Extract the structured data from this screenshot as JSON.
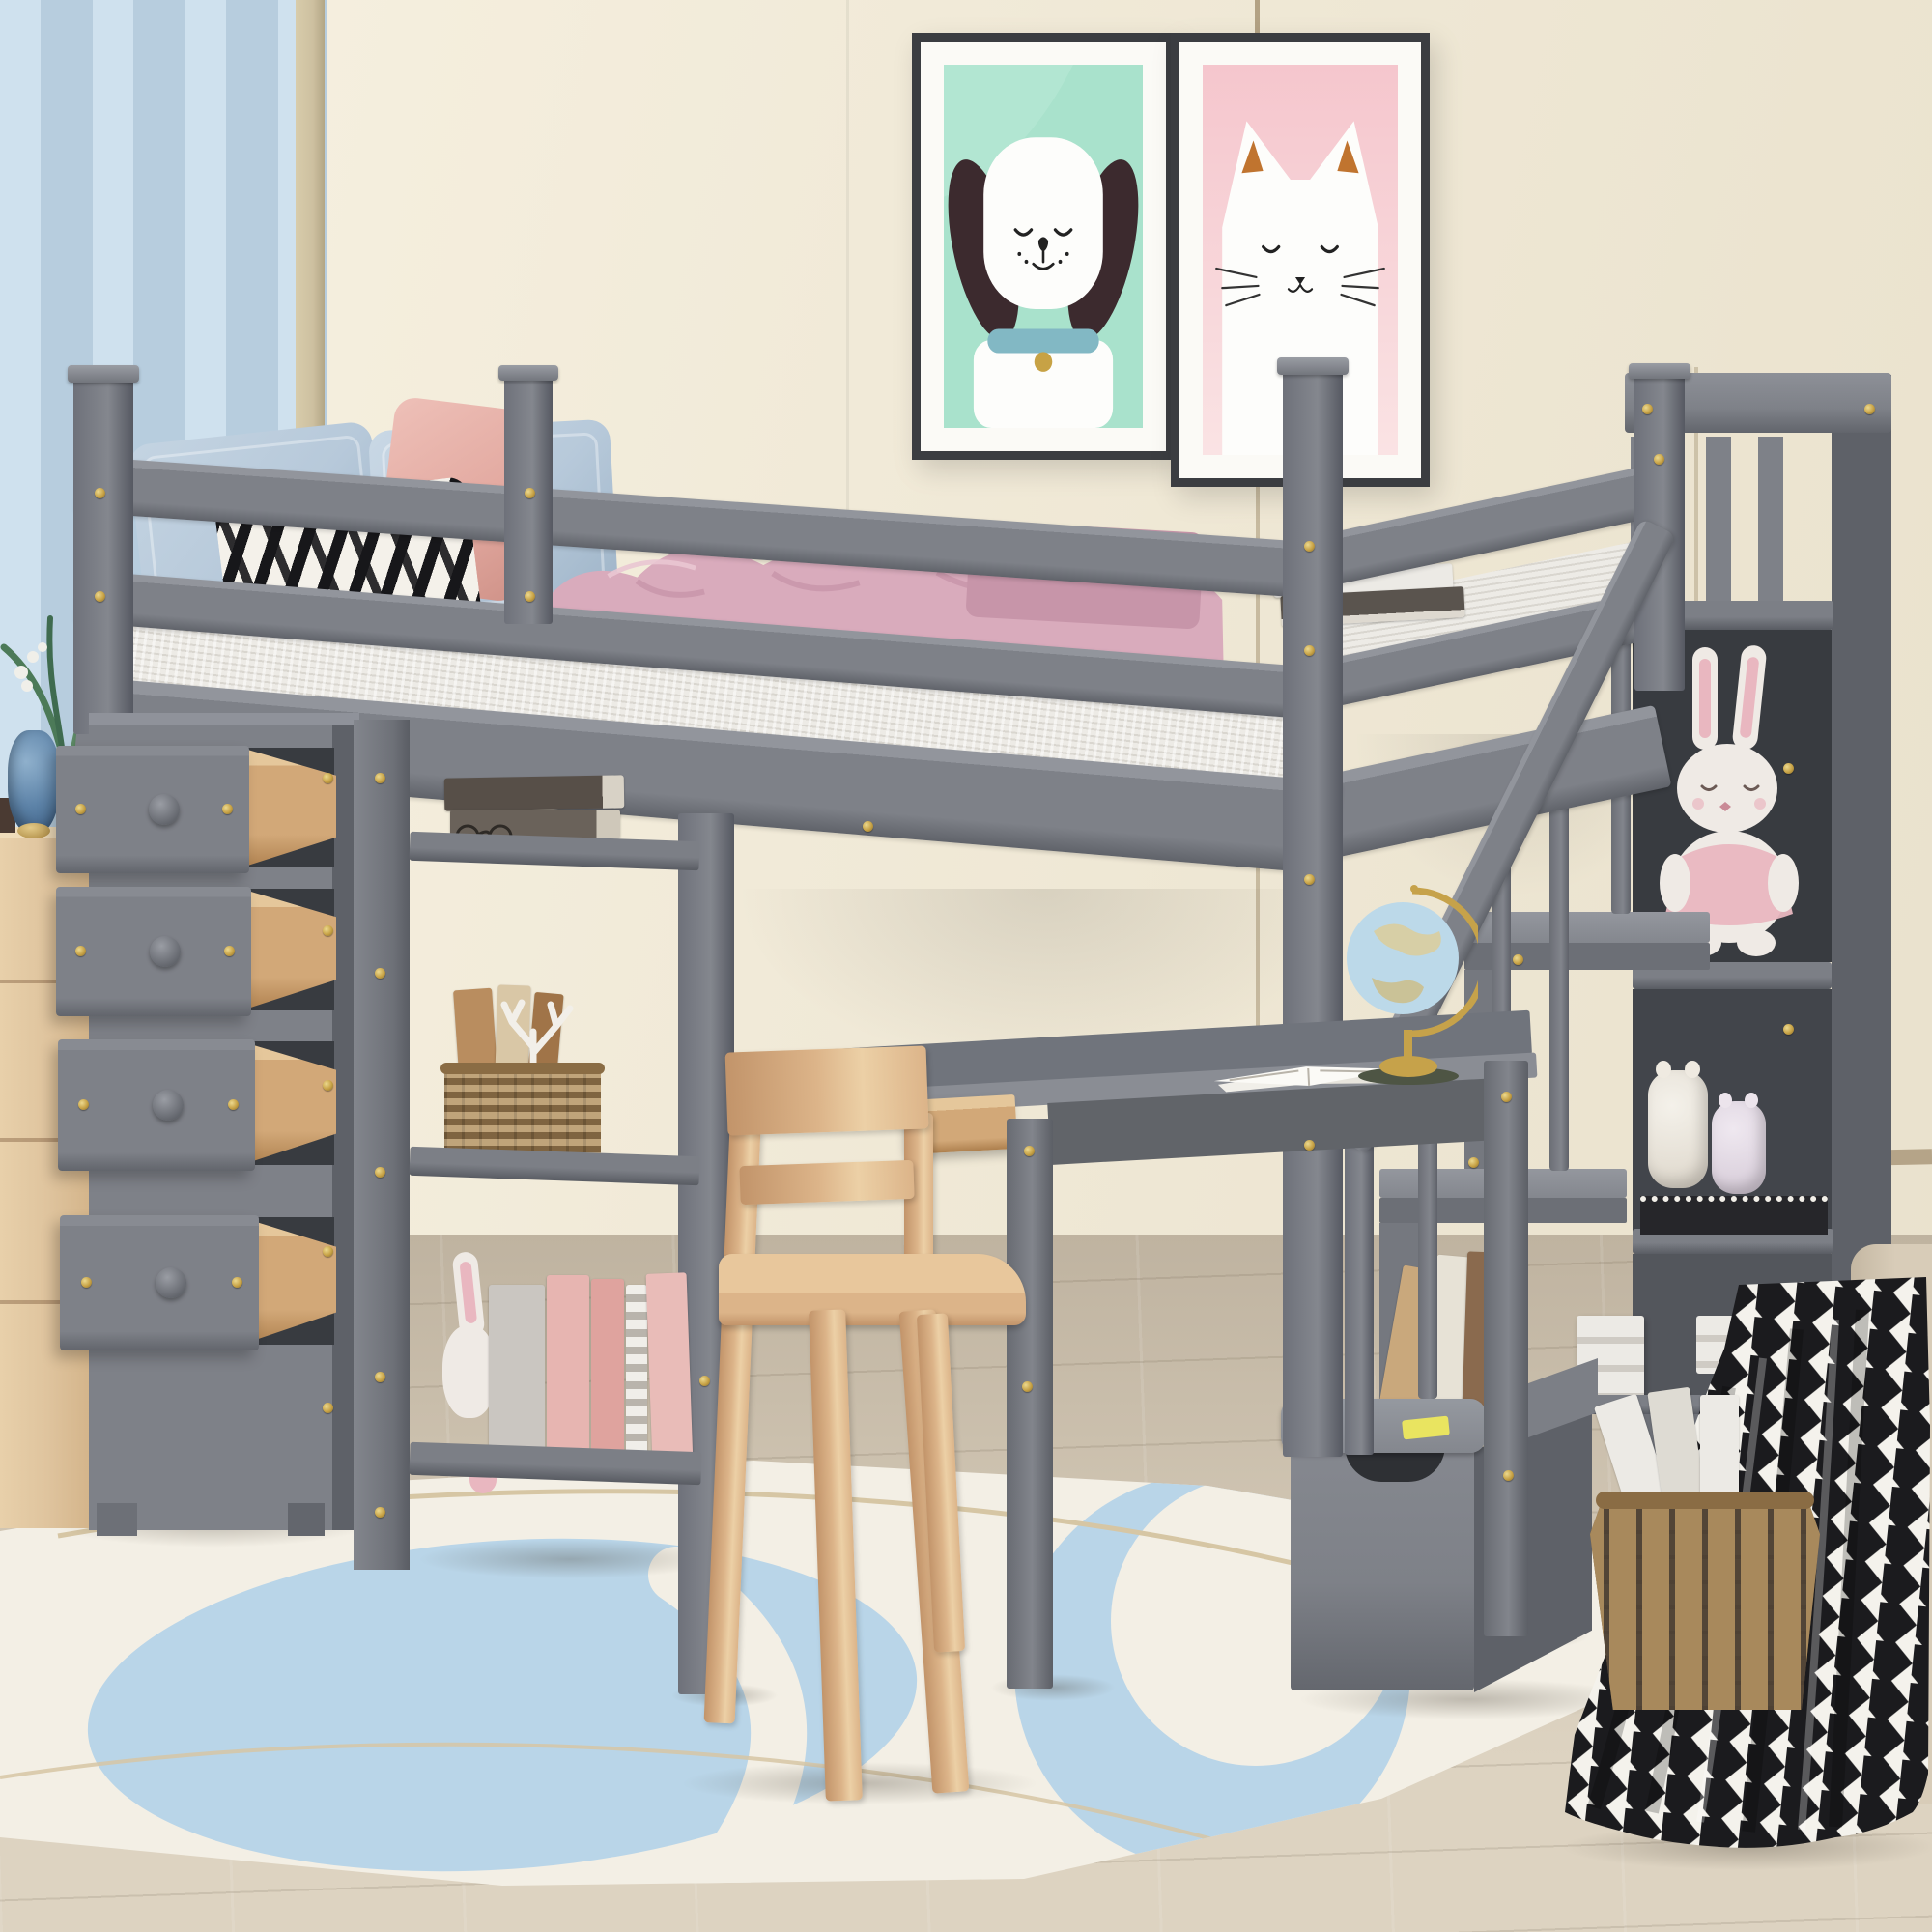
{
  "meta": {
    "caption": "Kids bedroom product photograph: gray wooden twin loft bed with four pull-out storage drawers, open bookshelves, built-in desk with globe, wooden chair, and a storage staircase with railing; two framed dog and cat posters on the wall, blue curtain and wooden dresser at left, wicker basket and houndstooth throw at right, light blue and cream area rug on a wood floor.",
    "image_type": "furniture product photo",
    "visible_text": ""
  },
  "colors": {
    "wall": "#f1ead8",
    "wallShade": "#e9e1cc",
    "wallBlue": "#bad0e0",
    "curtain": "#cfe1ee",
    "curtainFold": "#b7cdde",
    "tanStrip": "#cdc0a0",
    "trim": "#b5a488",
    "floor": "#c6baa7",
    "rugBase": "#f3efe5",
    "rugBlue": "#b9d5e8",
    "rugTan": "#d6c6a4",
    "rugPeach": "#edc5b5",
    "gray": "#7e8188",
    "grayLight": "#8f929a",
    "graySide": "#5e6168",
    "grayDeep": "#4b4e54",
    "grayInner": "#383b40",
    "grayTop": "#9a9da4",
    "gold": "#c7a245",
    "mattress": "#edebe6",
    "mattressShade": "#d9d6d0",
    "pillowBlue": "#b7c9da",
    "pillowBlueDeep": "#9db3c7",
    "pillowSalmon": "#e2a89f",
    "blanketPink": "#d9abbc",
    "blanketPinkDeep": "#c795a9",
    "zebraBlack": "#17171a",
    "zebraWhite": "#f4f1ea",
    "woodDrawer": "#d2a878",
    "woodDrawerLight": "#e5c79b",
    "chairWood": "#dcb489",
    "chairWoodDeep": "#c2946a",
    "dresserWood": "#dfc49e",
    "posterFrame": "#3b3d41",
    "posterMat": "#fbfaf6",
    "posterMint": "#a9e2cc",
    "posterPink": "#f5c6cd",
    "dogEar": "#3c2a2e",
    "dogCollar": "#82b8c4",
    "catEar": "#c0742f",
    "vaseBlue": "#5d83a8",
    "plantGreen": "#4c7a58",
    "globeSea": "#bcd9e9",
    "globeLand": "#d8cfa2",
    "globeGold": "#c6a24a",
    "globePad": "#4e5544",
    "bunnyWhite": "#efeae5",
    "bunnyPink": "#e9b7c0",
    "basket": "#a8895c",
    "basketDeep": "#6b573e",
    "houndB": "#1b1b1e",
    "houndW": "#f4f2ec",
    "bench": "#d8ccb8",
    "bookWhite": "#eceae5",
    "bookPink": "#e7b5b1",
    "bookGray": "#cac6c1",
    "bookDark": "#5a544e",
    "stickerYellow": "#e9e460"
  },
  "scene": {
    "objects": [
      "blue-curtain",
      "framed-dog-poster",
      "framed-cat-poster",
      "cream-paneled-wall",
      "wood-floor",
      "area-rug",
      "wooden-dresser",
      "blue-glass-vase",
      "green-plant",
      "gray-loft-bed",
      "guardrails",
      "white-mattress",
      "blue-pillows",
      "zebra-print-pillow",
      "salmon-pillow",
      "pink-throw-blanket",
      "books-on-bed",
      "four-storage-drawers",
      "open-drawer-wood-boxes",
      "bookshelf-tower",
      "stacked-dark-books",
      "reading-glasses",
      "wicker-shelf-basket",
      "white-coral-decor",
      "small-plush-bunny",
      "pink-books",
      "gray-desk",
      "open-desk-drawer",
      "desk-globe",
      "open-book",
      "wooden-chair",
      "storage-staircase",
      "stair-handrail",
      "stair-balusters",
      "large-plush-bunny",
      "plush-jar-toys",
      "leaning-books",
      "white-book-stacks",
      "staircase-storage-drawer",
      "seat-cushion",
      "yellow-sticker",
      "floor-basket",
      "magazines",
      "houndstooth-blanket",
      "upholstered-bench",
      "gold-screw-accents"
    ]
  }
}
